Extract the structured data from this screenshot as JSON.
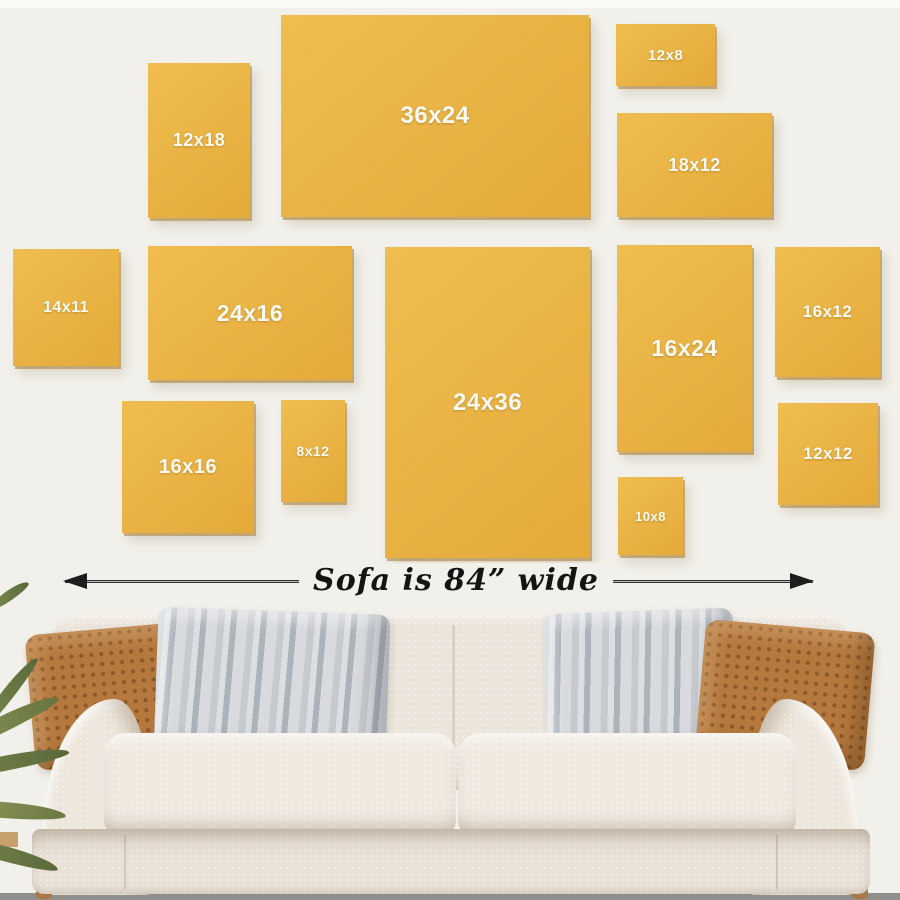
{
  "scene": {
    "wall_color": "#F2F0EA",
    "frame_color_light": "#EFBD50",
    "frame_color_dark": "#E4AA3A",
    "label_color": "#FCFAF5",
    "floor_color": "#8F8F8D",
    "sofa_color": "#ECE5DB",
    "pillow_brown": "#B5793E",
    "pillow_gray": "#C6CACF"
  },
  "frames": [
    {
      "label": "12x18",
      "x": 148,
      "y": 63,
      "w": 102,
      "h": 155,
      "fs": 18
    },
    {
      "label": "36x24",
      "x": 281,
      "y": 15,
      "w": 308,
      "h": 202,
      "fs": 24
    },
    {
      "label": "12x8",
      "x": 616,
      "y": 24,
      "w": 99,
      "h": 62,
      "fs": 15
    },
    {
      "label": "18x12",
      "x": 617,
      "y": 113,
      "w": 155,
      "h": 104,
      "fs": 18
    },
    {
      "label": "14x11",
      "x": 13,
      "y": 249,
      "w": 106,
      "h": 117,
      "fs": 16
    },
    {
      "label": "24x16",
      "x": 148,
      "y": 246,
      "w": 204,
      "h": 134,
      "fs": 23
    },
    {
      "label": "24x36",
      "x": 385,
      "y": 247,
      "w": 205,
      "h": 311,
      "fs": 24
    },
    {
      "label": "16x24",
      "x": 617,
      "y": 245,
      "w": 135,
      "h": 207,
      "fs": 23
    },
    {
      "label": "16x12",
      "x": 775,
      "y": 247,
      "w": 105,
      "h": 130,
      "fs": 17
    },
    {
      "label": "16x16",
      "x": 122,
      "y": 401,
      "w": 132,
      "h": 132,
      "fs": 20
    },
    {
      "label": "8x12",
      "x": 281,
      "y": 400,
      "w": 64,
      "h": 102,
      "fs": 14
    },
    {
      "label": "10x8",
      "x": 618,
      "y": 477,
      "w": 65,
      "h": 78,
      "fs": 13
    },
    {
      "label": "12x12",
      "x": 778,
      "y": 403,
      "w": 100,
      "h": 102,
      "fs": 17
    }
  ],
  "measurement": {
    "caption": "Sofa is 84” wide"
  }
}
